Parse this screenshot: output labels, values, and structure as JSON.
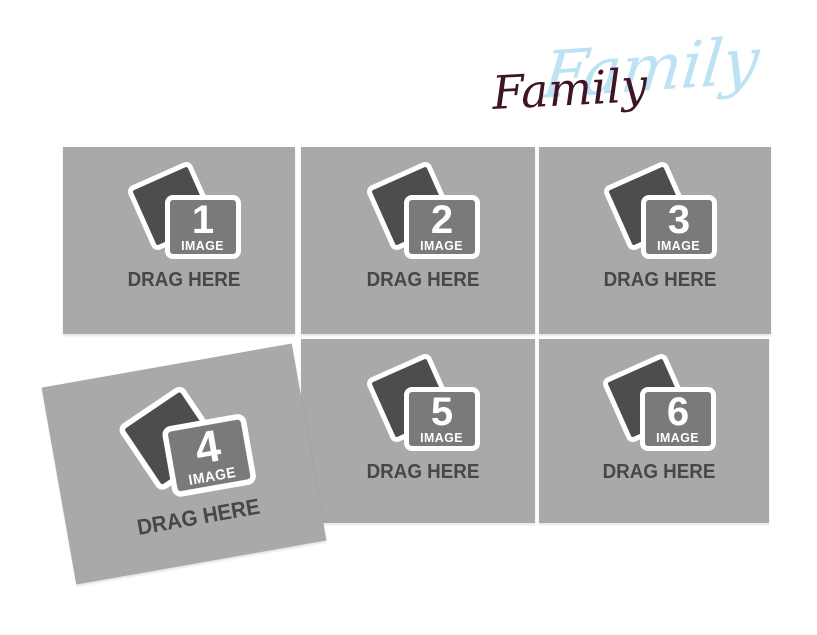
{
  "title": {
    "text": "Family",
    "script_shadow_text": "Family",
    "text_color": "#401424",
    "shadow_color": "#bde2f3"
  },
  "placeholders": [
    {
      "number": "1",
      "image_label": "IMAGE",
      "drag_label": "DRAG HERE"
    },
    {
      "number": "2",
      "image_label": "IMAGE",
      "drag_label": "DRAG HERE"
    },
    {
      "number": "3",
      "image_label": "IMAGE",
      "drag_label": "DRAG HERE"
    },
    {
      "number": "4",
      "image_label": "IMAGE",
      "drag_label": "DRAG HERE"
    },
    {
      "number": "5",
      "image_label": "IMAGE",
      "drag_label": "DRAG HERE"
    },
    {
      "number": "6",
      "image_label": "IMAGE",
      "drag_label": "DRAG HERE"
    }
  ],
  "colors": {
    "page_background": "#ffffff",
    "cell_background": "#a9a9a9",
    "photo_dark": "#4d4d4d",
    "photo_mid": "#7a7a7a",
    "frame_border": "#ffffff",
    "drag_text": "#474747"
  }
}
